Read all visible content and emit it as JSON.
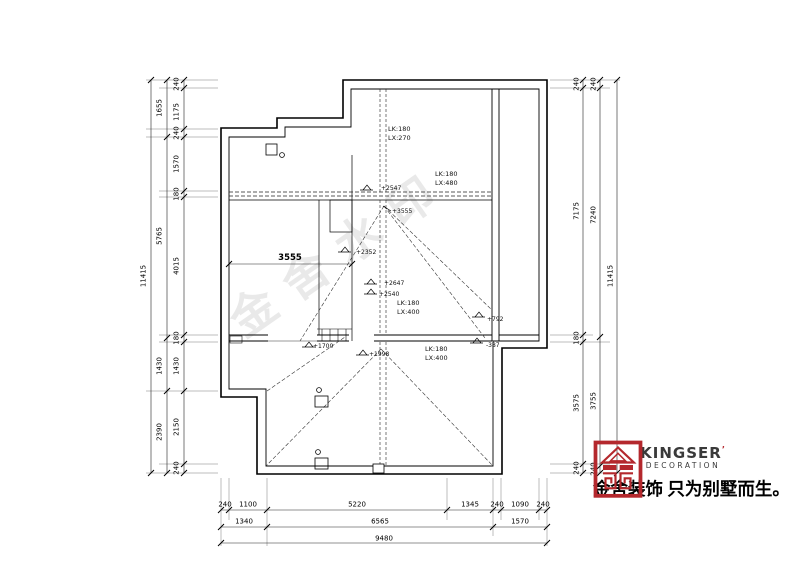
{
  "plan_labels": {
    "beam_top_l1": "LK:180",
    "beam_top_l2": "LX:270",
    "beam_mid_l1": "LK:180",
    "beam_mid_l2": "LX:480",
    "beam_center_l1": "LK:180",
    "beam_center_l2": "LX:400",
    "beam_lower_l1": "LK:180",
    "beam_lower_l2": "LX:400",
    "levels": {
      "a": "+2547",
      "b": "+3555",
      "c": "+2352",
      "d": "+2647",
      "e": "+2540",
      "f": "+1700",
      "g": "+1998",
      "h": "+792",
      "i": "-387"
    },
    "interior_dim": "3555"
  },
  "dims": {
    "left_outer": "11415",
    "left_mid": [
      "1655",
      "5765",
      "1430",
      "2390"
    ],
    "left_inner": [
      "240",
      "1175",
      "240",
      "1570",
      "180",
      "4015",
      "180",
      "1430",
      "2150",
      "240"
    ],
    "right_inner": [
      "240",
      "7175",
      "180",
      "3575",
      "240"
    ],
    "right_mid": [
      "240",
      "7240",
      "3755",
      "240"
    ],
    "right_outer": "11415",
    "bottom_row1": [
      "240",
      "1100",
      "5220",
      "1345",
      "240",
      "1090",
      "240"
    ],
    "bottom_row2": [
      "1340",
      "6565",
      "1570"
    ],
    "bottom_row3": "9480"
  },
  "watermark": "金舍水印",
  "logo": {
    "brand": "KINGSER",
    "mark": "’",
    "sub": "DECORATION",
    "slogan": "金舍装饰 只为别墅而生。",
    "red": "#B4282D"
  }
}
